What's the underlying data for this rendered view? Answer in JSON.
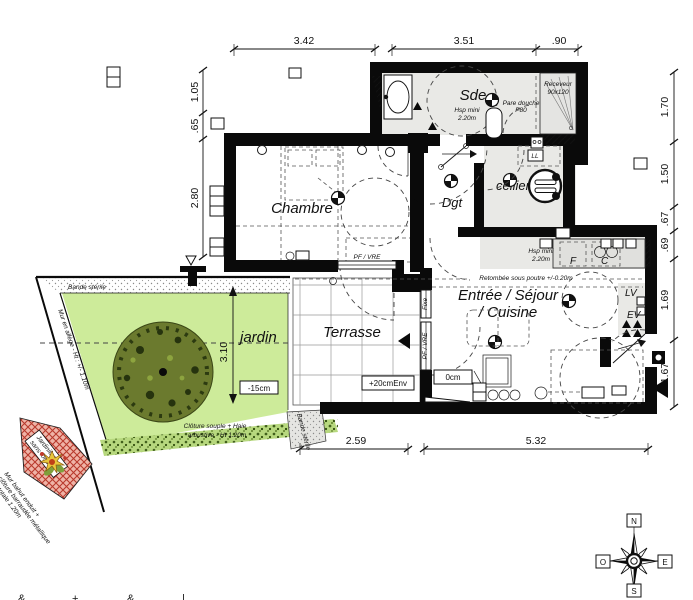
{
  "colors": {
    "wall": "#0a0a0a",
    "room_floor": "#e9e9e6",
    "kitchen_counter": "#e0e0dd",
    "garden_green": "#cdeb9a",
    "tree_canopy": "#6b7a2e",
    "tree_dark": "#2c3a10",
    "hedge_green": "#4e6b1f",
    "planter_red": "#d9534a",
    "flower_yellow": "#e8c73c"
  },
  "dimensions": {
    "top": [
      "3.42",
      "3.51",
      ".90"
    ],
    "left": [
      "1.05",
      ".65",
      "2.80"
    ],
    "right": [
      "1.70",
      "1.50",
      ".67",
      ".69",
      "1.69",
      "1.67"
    ],
    "bottom": [
      "2.59",
      "5.32"
    ],
    "garden_depth": "3.10"
  },
  "rooms": {
    "sde": "Sde",
    "chambre": "Chambre",
    "dgt": "Dgt",
    "cellier": "cellier",
    "sejour_line1": "Entrée / Séjour",
    "sejour_line2": "/ Cuisine",
    "terrasse": "Terrasse",
    "jardin": "jardin"
  },
  "annotations": {
    "sde_hsp_1": "Hsp mini",
    "sde_hsp_2": "2.20m",
    "receveur_1": "Receveur",
    "receveur_2": "90x120",
    "pare_douche_1": "Pare douche",
    "pare_douche_2": "P80",
    "kitchen_hsp_1": "Hsp mini",
    "kitchen_hsp_2": "2.20m",
    "beam": "Retombée sous poutre +/-0.20m",
    "pf_vre_chambre": "PF / VRE",
    "pf_vre_sejour": "PF / VRE",
    "fixe": "Fixe",
    "level_zero": "0cm",
    "level_terrasse": "+20cmEnv",
    "level_jardin": "-15cm",
    "bande_top": "Bande stérile",
    "bande_right": "Bande stérile",
    "mur_allege": "Mur en allège - Ht : +/- 1.10m",
    "cloture_1": "Clôture souple + Haie",
    "cloture_2": "arbustive - Ht 1.20m",
    "jardiniere_1": "Jardinière",
    "jardiniere_2": "sans fond",
    "mur_bahut_1": "Mur bahut enduit +",
    "mur_bahut_2": "clôture barraudée métallique",
    "mur_bahut_3": "Ht totale 1.20m"
  },
  "appliances": {
    "lave_linge": "LL",
    "lave_vaisselle": "LV",
    "evier": "EV",
    "four": "F",
    "cuisson": "C"
  },
  "compass": {
    "north": "N",
    "south": "S",
    "east": "E",
    "west": "O"
  }
}
